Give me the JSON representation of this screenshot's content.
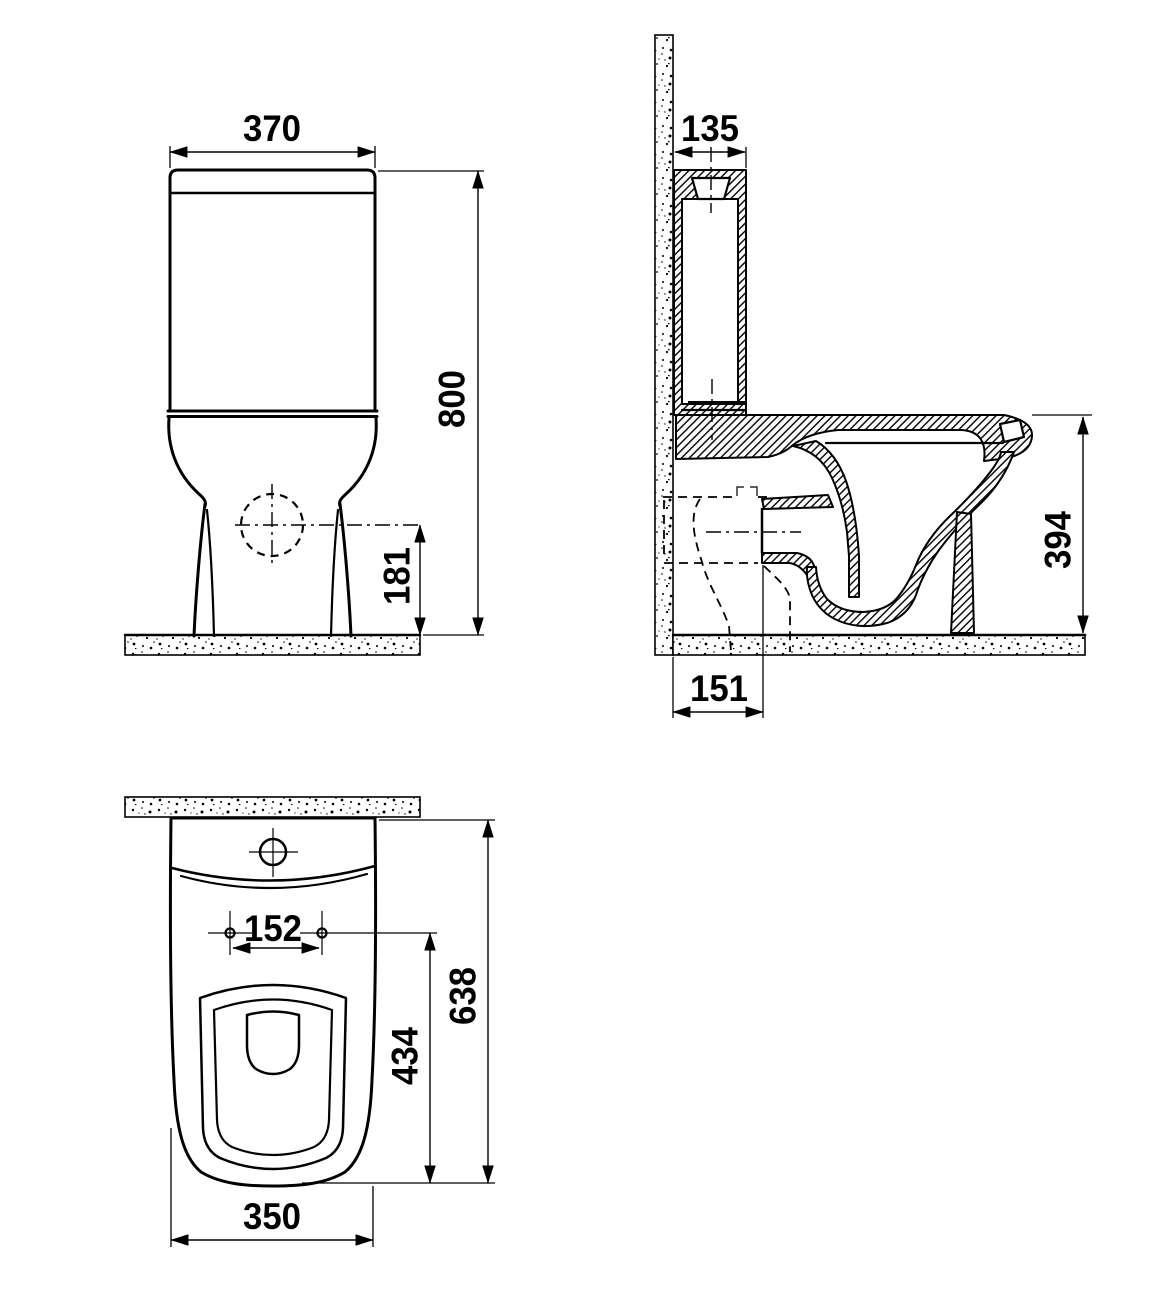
{
  "drawing": {
    "background_color": "#ffffff",
    "line_color": "#000000",
    "front_view": {
      "cistern_width": "370",
      "total_height": "800",
      "outlet_center_height": "181"
    },
    "side_view": {
      "cistern_top_depth": "135",
      "rim_height": "394",
      "outlet_offset_from_wall": "151"
    },
    "plan_view": {
      "seat_hole_spacing": "152",
      "holes_to_front_length": "434",
      "total_depth": "638",
      "bowl_width": "350"
    }
  }
}
